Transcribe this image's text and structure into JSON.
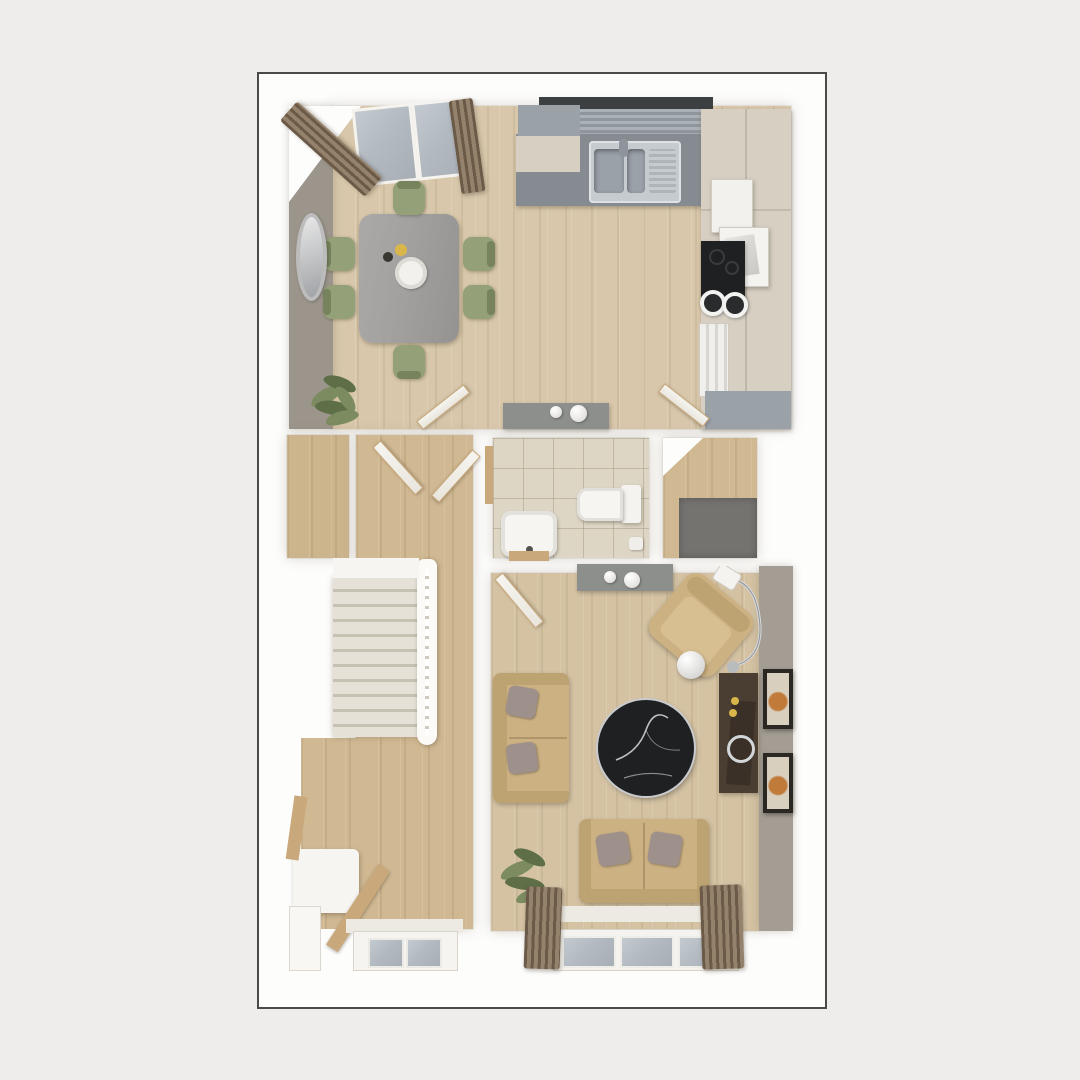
{
  "meta": {
    "kind": "3d-floorplan-top-down-render",
    "floor": "ground-floor",
    "visible_text": "none"
  },
  "palette": {
    "page_bg": "#eeedeb",
    "card_bg": "#fdfdfc",
    "card_border": "#4a4a4a",
    "wood_kitchen": "#d8c7aa",
    "wood_hall": "#cfb892",
    "wood_living": "#d4c2a3",
    "wood_alcove": "#ccb48d",
    "wall_taupe": "#9c958b",
    "wall_taupe_living": "#a39d93",
    "tile_wc": "#ded6c5",
    "counter_gray": "#858b91",
    "cabinet_cream": "#d6cfc2",
    "cabinet_gray": "#9aa1a7",
    "blind_dark": "#3c4043",
    "steel": "#c6cbd0",
    "steel_dark": "#9aa1a8",
    "table_gray": "#a3a2a0",
    "chair_green": "#94a077",
    "chair_green_dark": "#76835c",
    "sofa_tan": "#ccb183",
    "sofa_tan_dark": "#bda272",
    "cushion_gray": "#9e918c",
    "curtain_brown": "#95826c",
    "curtain_dark": "#6b5a47",
    "glass": "#b3bac1",
    "media_dark": "#4a3e33",
    "mat_gray": "#747370",
    "marble_black": "#1f2022",
    "stairs_tread": "#e5e1d7",
    "stairs_edge": "#c6c1b3",
    "console_gray": "#8d8f8d",
    "wood_accent": "#c9a97b",
    "plant_green": "#7c8c60",
    "plant_green_dark": "#5e6f47",
    "frame_dark": "#2b2723",
    "gold": "#d9b64a",
    "white": "#ffffff"
  },
  "rooms": [
    {
      "id": "kitchen-dining",
      "label": "Kitchen / Dining room",
      "furniture": [
        "french-doors",
        "curtains",
        "dining-table",
        "six-green-chairs",
        "round-wall-mirror",
        "potted-plant",
        "sink-run-worktop",
        "window-blind",
        "tall-units-oven-hob",
        "sideboard-with-vases"
      ]
    },
    {
      "id": "hallway",
      "label": "Hallway with staircase",
      "furniture": [
        "staircase",
        "balustrade",
        "storage-alcove",
        "console-table",
        "leaning-ladder-decor",
        "wall-shelf",
        "front-door"
      ]
    },
    {
      "id": "wc",
      "label": "WC / Cloakroom",
      "furniture": [
        "toilet",
        "basin-with-wood-stand",
        "toilet-roll-holder"
      ]
    },
    {
      "id": "entry-nook",
      "label": "Entry nook",
      "furniture": [
        "door-mat"
      ]
    },
    {
      "id": "living-room",
      "label": "Living room",
      "furniture": [
        "two-seat-sofa-left",
        "loveseat-bottom",
        "armchair",
        "arc-floor-lamp",
        "round-side-table",
        "black-marble-coffee-table",
        "media-sideboard",
        "wall-art-frames",
        "console-with-vases",
        "potted-plant",
        "triple-window",
        "curtains"
      ]
    }
  ]
}
